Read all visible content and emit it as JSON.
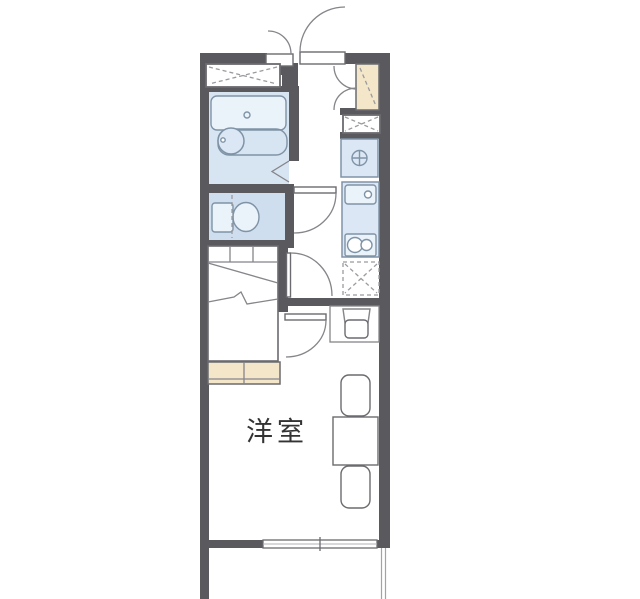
{
  "floorplan": {
    "room_label": "洋室",
    "colors": {
      "wall": "#59595e",
      "box_line": "#6b6b70",
      "line": "#85858a",
      "dash": "#9b9b9f",
      "fixture_line": "#7f93a6",
      "fixture_fill": "#dbe7f4",
      "fixture_light": "#eaf2fa",
      "storage_fill": "#f3e6c9",
      "bath_fill": "#d7e4f2",
      "toilet_fill": "#cfdeef",
      "rail": "#a3a3a7",
      "label": "#333333"
    }
  }
}
